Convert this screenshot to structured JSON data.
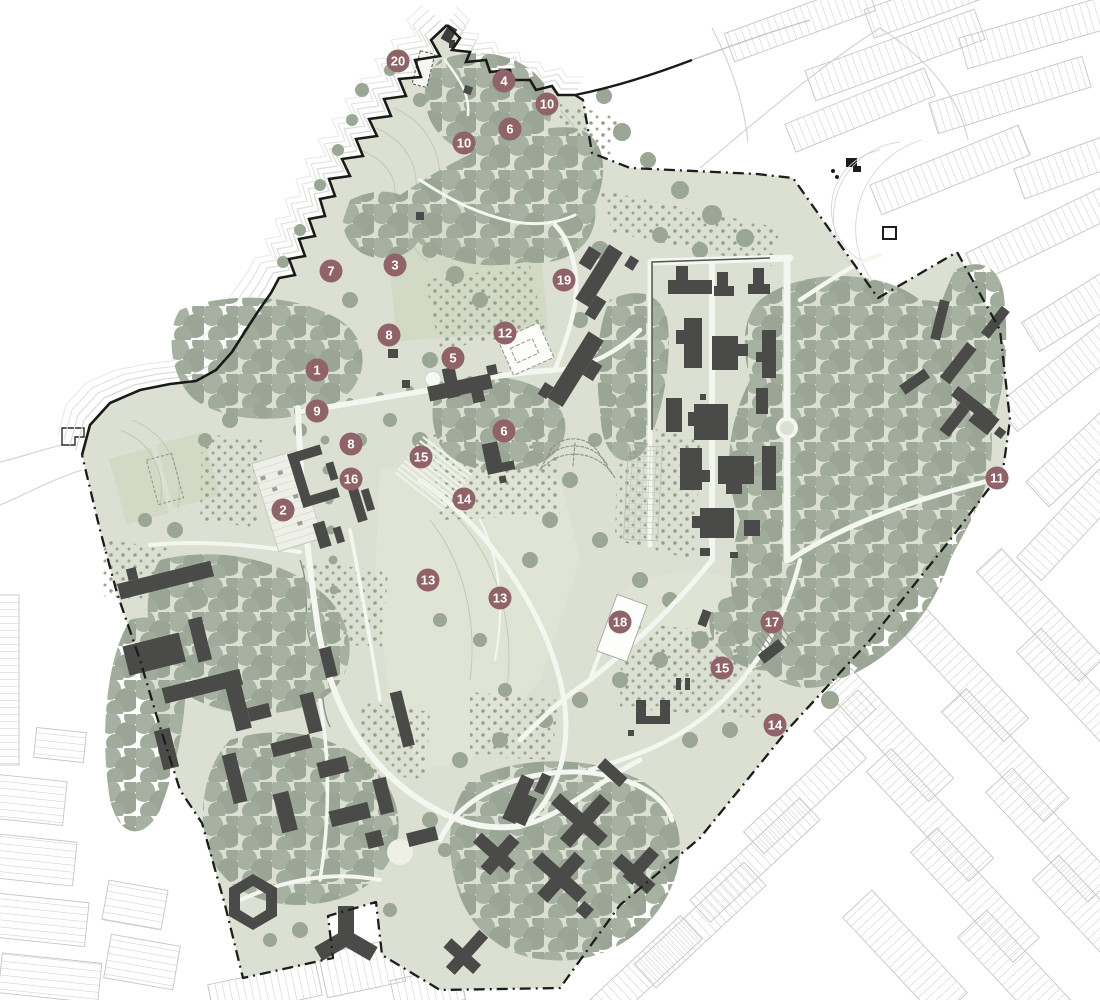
{
  "page": {
    "title": "Masterplan site map with numbered key locations"
  },
  "colors": {
    "site_base": "#DCE0D2",
    "field": "#D2D9C4",
    "lawn": "#E0E4D4",
    "canopy": "#A2AC9C",
    "canopy_dark": "#97A293",
    "building": "#4A4B48",
    "boundary": "#1E1E1C",
    "context_street": "#C7CAC4",
    "ripple": "#D8DCD6",
    "marker": "#8F6367"
  },
  "map": {
    "width": 1100,
    "height": 1000,
    "marker_style": {
      "fill": "#8F6367",
      "text_color": "#FFFFFF",
      "radius": 11.5
    },
    "legend_markers": [
      {
        "id": "m-20",
        "label": "20",
        "x": 398,
        "y": 61
      },
      {
        "id": "m-4",
        "label": "4",
        "x": 504,
        "y": 81
      },
      {
        "id": "m-10a",
        "label": "10",
        "x": 547,
        "y": 104
      },
      {
        "id": "m-6a",
        "label": "6",
        "x": 510,
        "y": 129
      },
      {
        "id": "m-10b",
        "label": "10",
        "x": 464,
        "y": 143
      },
      {
        "id": "m-7",
        "label": "7",
        "x": 331,
        "y": 271
      },
      {
        "id": "m-3",
        "label": "3",
        "x": 395,
        "y": 265
      },
      {
        "id": "m-19",
        "label": "19",
        "x": 564,
        "y": 280
      },
      {
        "id": "m-8a",
        "label": "8",
        "x": 389,
        "y": 335
      },
      {
        "id": "m-12",
        "label": "12",
        "x": 505,
        "y": 333
      },
      {
        "id": "m-5",
        "label": "5",
        "x": 453,
        "y": 358
      },
      {
        "id": "m-1",
        "label": "1",
        "x": 317,
        "y": 370
      },
      {
        "id": "m-9",
        "label": "9",
        "x": 317,
        "y": 411
      },
      {
        "id": "m-6b",
        "label": "6",
        "x": 504,
        "y": 431
      },
      {
        "id": "m-8b",
        "label": "8",
        "x": 351,
        "y": 444
      },
      {
        "id": "m-15a",
        "label": "15",
        "x": 421,
        "y": 457
      },
      {
        "id": "m-16",
        "label": "16",
        "x": 351,
        "y": 479
      },
      {
        "id": "m-14a",
        "label": "14",
        "x": 464,
        "y": 499
      },
      {
        "id": "m-2",
        "label": "2",
        "x": 283,
        "y": 510
      },
      {
        "id": "m-13a",
        "label": "13",
        "x": 428,
        "y": 580
      },
      {
        "id": "m-13b",
        "label": "13",
        "x": 500,
        "y": 598
      },
      {
        "id": "m-18",
        "label": "18",
        "x": 620,
        "y": 622
      },
      {
        "id": "m-17",
        "label": "17",
        "x": 772,
        "y": 622
      },
      {
        "id": "m-15b",
        "label": "15",
        "x": 722,
        "y": 668
      },
      {
        "id": "m-14b",
        "label": "14",
        "x": 775,
        "y": 725
      },
      {
        "id": "m-11",
        "label": "11",
        "x": 997,
        "y": 478
      }
    ]
  }
}
